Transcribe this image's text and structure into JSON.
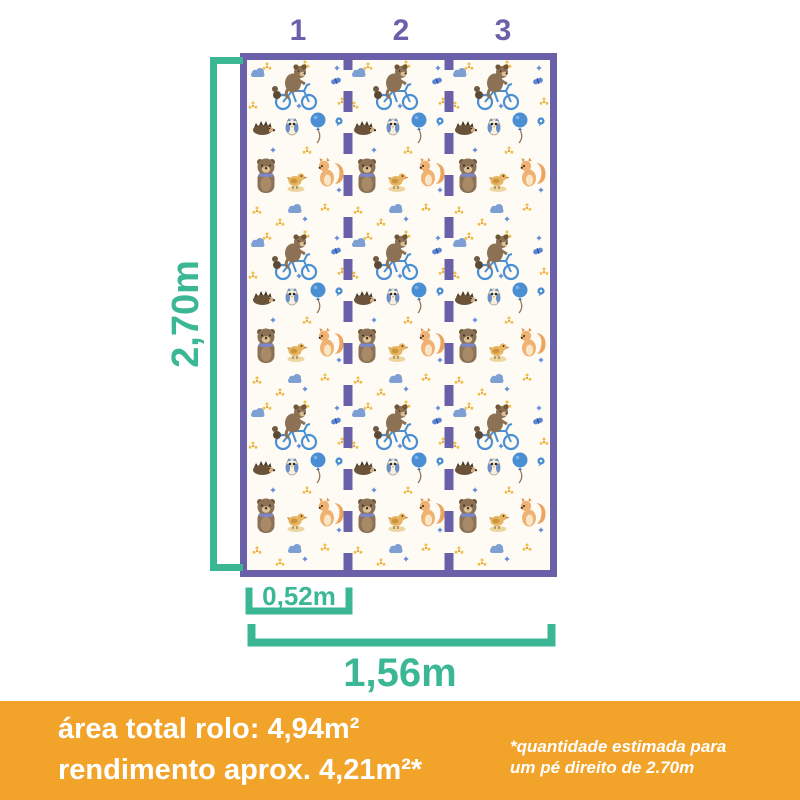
{
  "strips": {
    "labels": [
      "1",
      "2",
      "3"
    ]
  },
  "measurements": {
    "height": "2,70m",
    "strip_width": "0,52m",
    "roll_width": "1,56m"
  },
  "footer": {
    "area_total": "área total rolo: 4,94m²",
    "yield": "rendimento aprox. 4,21m²*",
    "note_line1": "*quantidade estimada para",
    "note_line2": "um pé direito de 2.70m"
  },
  "colors": {
    "purple": "#6a60aa",
    "teal": "#3bb795",
    "orange": "#f2a32a",
    "white": "#ffffff"
  },
  "pattern": {
    "motifs": [
      "bear-on-bicycle",
      "standing-bear",
      "hedgehog",
      "owl",
      "bird",
      "squirrel",
      "balloon",
      "cloud",
      "butterfly",
      "flower-sprinkles"
    ]
  }
}
